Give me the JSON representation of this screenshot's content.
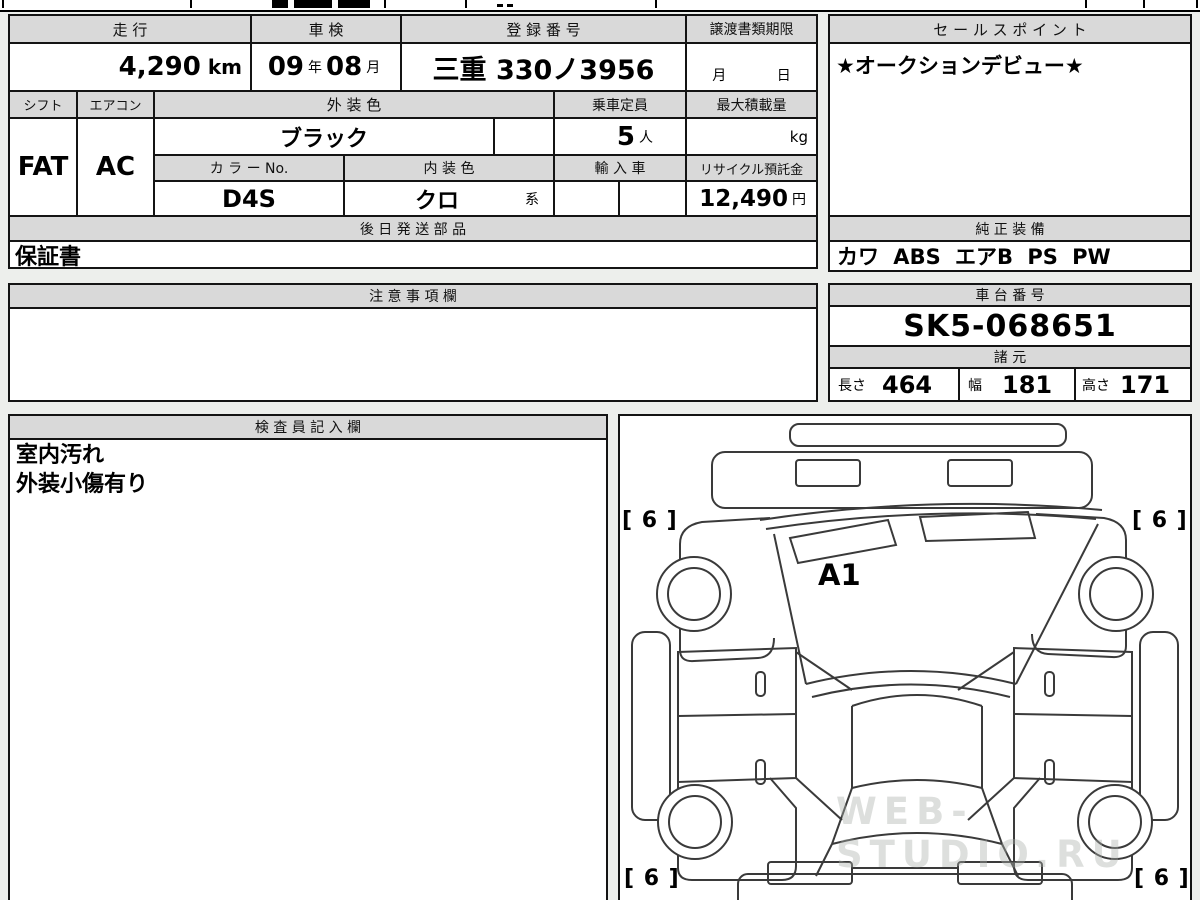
{
  "table1": {
    "mileage": {
      "label": "走 行",
      "value": "4,290",
      "unit": "km"
    },
    "inspection": {
      "label": "車 検",
      "year": "09",
      "year_unit": "年",
      "month": "08",
      "month_unit": "月"
    },
    "registration": {
      "label": "登 録 番 号",
      "value": "三重 330ノ3956"
    },
    "transfer": {
      "label": "譲渡書類期限",
      "month_unit": "月",
      "day_unit": "日"
    },
    "shift": {
      "label": "シフト",
      "value": "FAT"
    },
    "aircon": {
      "label": "エアコン",
      "value": "AC"
    },
    "exterior": {
      "label": "外 装 色",
      "value": "ブラック"
    },
    "color_no": {
      "label": "カ ラ ー No.",
      "value": "D4S"
    },
    "interior": {
      "label": "内 装 色",
      "value": "クロ",
      "suffix": "系"
    },
    "capacity": {
      "label": "乗車定員",
      "value": "5",
      "unit": "人"
    },
    "max_load": {
      "label": "最大積載量",
      "unit": "kg"
    },
    "import_car": {
      "label": "輸 入 車"
    },
    "recycle": {
      "label": "リサイクル預託金",
      "value": "12,490",
      "unit": "円"
    },
    "later_parts": {
      "label": "後 日 発 送 部 品",
      "value": "保証書"
    }
  },
  "sales_point": {
    "label": "セ ー ル ス ポ イ ン ト",
    "value": "★オークションデビュー★"
  },
  "equipment": {
    "label": "純 正 装 備",
    "value": "カワ ABS エアB PS PW"
  },
  "notes": {
    "label": "注 意 事 項 欄",
    "value": ""
  },
  "chassis": {
    "label": "車 台 番 号",
    "value": "SK5-068651"
  },
  "specs": {
    "label": "諸 元",
    "length_label": "長さ",
    "length": "464",
    "width_label": "幅",
    "width": "181",
    "height_label": "高さ",
    "height": "171"
  },
  "inspector": {
    "label": "検 査 員 記 入 欄",
    "line1": "室内汚れ",
    "line2": "外装小傷有り"
  },
  "diagram": {
    "tire_front_left": "[ 6 ]",
    "tire_front_right": "[ 6 ]",
    "tire_rear_left": "[ 6 ]",
    "tire_rear_right": "[ 6 ]",
    "grade_mark": "A1"
  },
  "watermark": "WEB-STUDIO.RU"
}
